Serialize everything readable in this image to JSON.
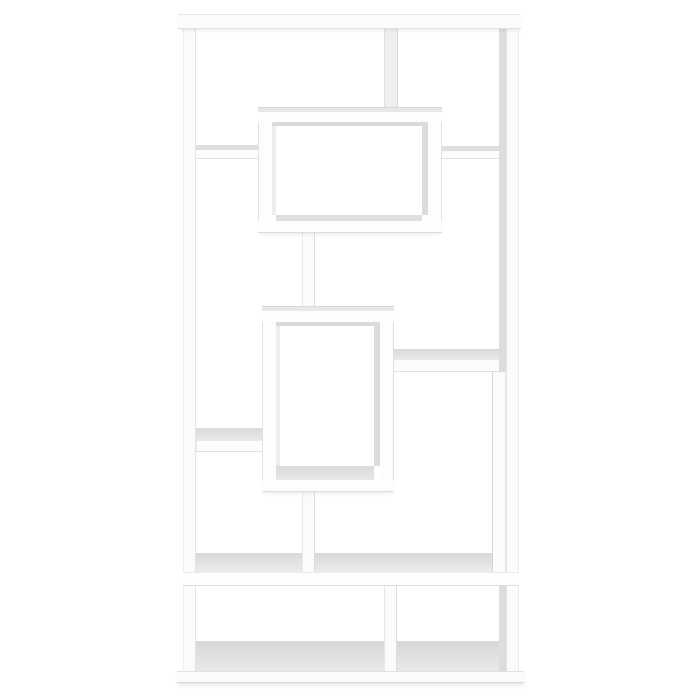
{
  "meta": {
    "description": "Product photo of a white geometric open-back bookcase with interlocking rectangular shelves on a plain white background",
    "background_color": "#ffffff",
    "furniture_color": "#fcfcfd",
    "shade_color": "#dcdcde"
  },
  "scene": {
    "width": 700,
    "height": 700,
    "pieces": [
      {
        "name": "right-panel-inner-face",
        "x": 499,
        "y": 29,
        "w": 7,
        "h": 643,
        "fill": "#dddddf"
      },
      {
        "name": "bottom-floor-left",
        "x": 196,
        "y": 641,
        "w": 188,
        "h": 31,
        "fill": "linear-gradient(180deg,#d7d7d8,#eaeae9)"
      },
      {
        "name": "bottom-floor-right",
        "x": 397,
        "y": 641,
        "w": 102,
        "h": 31,
        "fill": "linear-gradient(180deg,#d7d7d8,#eaeae9)"
      },
      {
        "name": "middle-shelf-top-face",
        "x": 196,
        "y": 553,
        "w": 303,
        "h": 19,
        "fill": "linear-gradient(180deg,#d9d9db,#ebebeb)"
      },
      {
        "name": "upper-left-shelf-top-face",
        "x": 196,
        "y": 145,
        "w": 62,
        "h": 5,
        "fill": "#dedee0"
      },
      {
        "name": "upper-right-shelf-top-face",
        "x": 442,
        "y": 146,
        "w": 57,
        "h": 5,
        "fill": "#dedee0"
      },
      {
        "name": "mid-right-shelf-top-face",
        "x": 394,
        "y": 349,
        "w": 105,
        "h": 11,
        "fill": "linear-gradient(180deg,#d9d9db,#e9e9ea)"
      },
      {
        "name": "mid-left-shelf-top-face",
        "x": 196,
        "y": 428,
        "w": 66,
        "h": 13,
        "fill": "linear-gradient(180deg,#dadadc,#eaeaea)"
      },
      {
        "name": "left-side-panel",
        "x": 183,
        "y": 27,
        "w": 13,
        "h": 645,
        "fill": "#fbfbfc",
        "edges": {
          "l": "#eeeeef",
          "r": "#e4e4e6"
        }
      },
      {
        "name": "right-side-panel",
        "x": 506,
        "y": 27,
        "w": 13,
        "h": 645,
        "fill": "#fbfbfc",
        "edges": {
          "l": "#e3e3e5",
          "r": "#ebebec"
        }
      },
      {
        "name": "top-section-divider",
        "x": 384,
        "y": 29,
        "w": 14,
        "h": 80,
        "fill": "#efeff1",
        "edges": {
          "l": "#dfdfe1",
          "r": "#d8d8da"
        }
      },
      {
        "name": "upper-left-shelf-front",
        "x": 196,
        "y": 150,
        "w": 62,
        "h": 9,
        "fill": "#fcfcfd",
        "edges": {
          "b": "#e1e1e3"
        }
      },
      {
        "name": "upper-right-shelf-front",
        "x": 442,
        "y": 151,
        "w": 57,
        "h": 8,
        "fill": "#fcfcfd",
        "edges": {
          "b": "#e1e1e3"
        }
      },
      {
        "name": "mid-right-shelf-front",
        "x": 394,
        "y": 360,
        "w": 105,
        "h": 12,
        "fill": "#fcfcfd",
        "edges": {
          "b": "#e0e0e2"
        }
      },
      {
        "name": "mid-left-shelf-front",
        "x": 196,
        "y": 441,
        "w": 66,
        "h": 11,
        "fill": "#fcfcfd",
        "edges": {
          "b": "#e0e0e2",
          "l": "#ececee"
        }
      },
      {
        "name": "upper-center-post",
        "x": 302,
        "y": 233,
        "w": 13,
        "h": 78,
        "fill": "#fbfbfc",
        "edges": {
          "l": "#eaeaec",
          "r": "#dcdcde"
        }
      },
      {
        "name": "lower-center-post",
        "x": 302,
        "y": 492,
        "w": 13,
        "h": 80,
        "fill": "#fbfbfc",
        "edges": {
          "l": "#eaeaec",
          "r": "#dcdcde"
        }
      },
      {
        "name": "right-hanging-divider",
        "x": 492,
        "y": 372,
        "w": 14,
        "h": 200,
        "fill": "#fbfbfc",
        "edges": {
          "l": "#d6d6d8",
          "r": "#e9e9eb"
        }
      },
      {
        "name": "bottom-section-divider",
        "x": 384,
        "y": 586,
        "w": 13,
        "h": 85,
        "fill": "#fbfbfc",
        "edges": {
          "l": "#e7e7e9",
          "r": "#dcdcde"
        }
      },
      {
        "name": "middle-shelf-front",
        "x": 183,
        "y": 572,
        "w": 336,
        "h": 14,
        "fill": "#fdfdfe",
        "edges": {
          "t": "#ebebec",
          "b": "#dfdfe1"
        }
      },
      {
        "name": "top-board",
        "x": 178,
        "y": 14,
        "w": 343,
        "h": 15,
        "fill": "#fcfcfd",
        "edges": {
          "t": "#e6e6e8",
          "b": "#e2e2e4"
        },
        "shadow": "0 3px 5px -2px rgba(30,30,40,0.10)"
      },
      {
        "name": "base-board",
        "x": 177,
        "y": 671,
        "w": 347,
        "h": 12,
        "fill": "#fcfcfd",
        "edges": {
          "t": "#e1e1e3",
          "b": "#d8d8da"
        },
        "shadow": "0 3px 4px -1px rgba(30,30,40,0.12)"
      },
      {
        "name": "upper-box-left-wall",
        "x": 258,
        "y": 107,
        "w": 14,
        "h": 126,
        "fill": "#fdfdfe",
        "edges": {
          "l": "#e2e2e4"
        }
      },
      {
        "name": "upper-box-right-wall",
        "x": 428,
        "y": 107,
        "w": 14,
        "h": 126,
        "fill": "#fdfdfe",
        "edges": {
          "r": "#e2e2e4"
        }
      },
      {
        "name": "upper-box-top-face",
        "x": 258,
        "y": 107,
        "w": 184,
        "h": 5,
        "fill": "#e7e7e9",
        "edges": {
          "t": "#d6d6d8"
        }
      },
      {
        "name": "upper-box-top-front",
        "x": 258,
        "y": 112,
        "w": 184,
        "h": 10,
        "fill": "#fdfdfe"
      },
      {
        "name": "upper-box-ceiling-edge",
        "x": 272,
        "y": 122,
        "w": 156,
        "h": 4,
        "fill": "#dadadc"
      },
      {
        "name": "upper-box-left-inner-face",
        "x": 272,
        "y": 126,
        "w": 4,
        "h": 89,
        "fill": "#ededef"
      },
      {
        "name": "upper-box-right-inner-face",
        "x": 422,
        "y": 126,
        "w": 6,
        "h": 89,
        "fill": "#dcdcde"
      },
      {
        "name": "upper-box-floor-edge",
        "x": 276,
        "y": 215,
        "w": 146,
        "h": 6,
        "fill": "#dfdfe1"
      },
      {
        "name": "upper-box-bottom-front",
        "x": 258,
        "y": 221,
        "w": 184,
        "h": 12,
        "fill": "#fdfdfe",
        "edges": {
          "b": "#dddddf"
        },
        "shadow": "0 3px 5px -2px rgba(30,30,40,0.10)"
      },
      {
        "name": "lower-box-left-wall",
        "x": 262,
        "y": 306,
        "w": 14,
        "h": 186,
        "fill": "#fdfdfe",
        "edges": {
          "l": "#e2e2e4"
        }
      },
      {
        "name": "lower-box-right-wall",
        "x": 380,
        "y": 306,
        "w": 14,
        "h": 186,
        "fill": "#fdfdfe",
        "edges": {
          "r": "#dfdfe1"
        }
      },
      {
        "name": "lower-box-top-face",
        "x": 262,
        "y": 306,
        "w": 132,
        "h": 5,
        "fill": "#e8e8e9",
        "edges": {
          "t": "#d8d8da"
        }
      },
      {
        "name": "lower-box-top-front",
        "x": 262,
        "y": 311,
        "w": 132,
        "h": 11,
        "fill": "#fdfdfe"
      },
      {
        "name": "lower-box-ceiling-edge",
        "x": 276,
        "y": 322,
        "w": 104,
        "h": 4,
        "fill": "#dadadc"
      },
      {
        "name": "lower-box-left-inner-face",
        "x": 276,
        "y": 326,
        "w": 4,
        "h": 140,
        "fill": "#ededef"
      },
      {
        "name": "lower-box-right-inner-face",
        "x": 374,
        "y": 326,
        "w": 6,
        "h": 140,
        "fill": "#dcdcde"
      },
      {
        "name": "lower-box-floor-face",
        "x": 276,
        "y": 466,
        "w": 98,
        "h": 14,
        "fill": "linear-gradient(180deg,#d9d9db,#e7e7e7)"
      },
      {
        "name": "lower-box-bottom-front",
        "x": 262,
        "y": 480,
        "w": 132,
        "h": 12,
        "fill": "#fdfdfe",
        "edges": {
          "b": "#dddddf"
        },
        "shadow": "0 3px 5px -2px rgba(30,30,40,0.10)"
      }
    ]
  }
}
